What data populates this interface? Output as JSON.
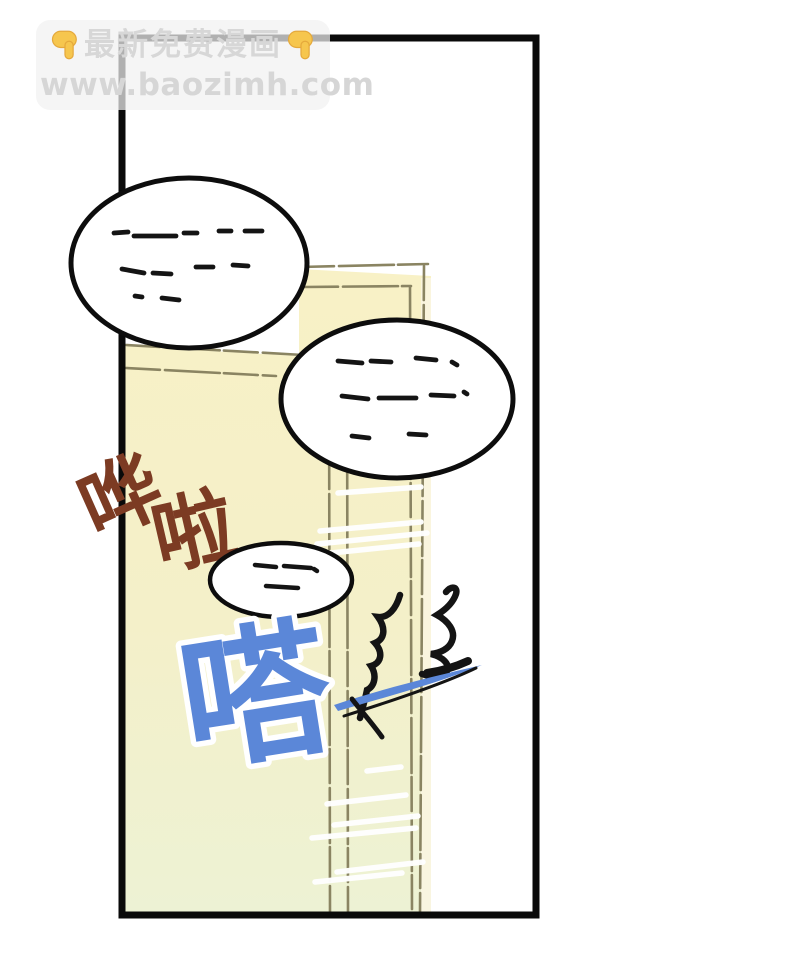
{
  "watermark": {
    "line1": "最新免费漫画",
    "line2": "www.baozimh.com",
    "hand_color": "#f6c64e"
  },
  "panel": {
    "background": "#ffffff",
    "border_color": "#0a0a0a"
  },
  "door": {
    "top_fill": "#f8f1c6",
    "bottom_fill": "#edf2d4",
    "frame_line_color": "#8a8462",
    "motion_streak_color": "#ffffff"
  },
  "sfx": {
    "hua": {
      "text": "哗",
      "color": "#7c3b23"
    },
    "la": {
      "text": "啦",
      "color": "#7c3b23"
    },
    "da": {
      "text": "嗒",
      "color": "#5b87d8",
      "halo": "#ffffff"
    }
  },
  "effects": {
    "burst_color": "#141414",
    "swoosh_color": "#5b87d8"
  },
  "bubbles": [
    {
      "id": "top-left",
      "content": "illegible scribble dashes"
    },
    {
      "id": "middle",
      "content": "illegible scribble dashes"
    },
    {
      "id": "small",
      "content": "illegible scribble dashes"
    }
  ]
}
